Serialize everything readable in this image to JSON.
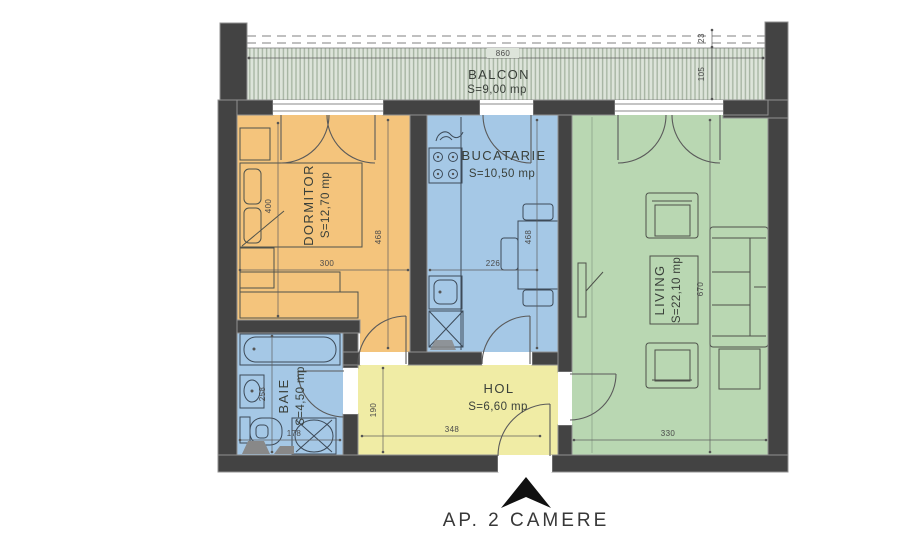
{
  "title": "AP. 2 CAMERE",
  "balcony": {
    "name": "BALCON",
    "area": "S=9,00 mp"
  },
  "rooms": {
    "dormitor": {
      "name": "DORMITOR",
      "area": "S=12,70 mp"
    },
    "bucatarie": {
      "name": "BUCATARIE",
      "area": "S=10,50 mp"
    },
    "living": {
      "name": "LIVING",
      "area": "S=22,10 mp"
    },
    "baie": {
      "name": "BAIE",
      "area": "S=4,50 mp"
    },
    "hol": {
      "name": "HOL",
      "area": "S=6,60 mp"
    }
  },
  "dimensions": {
    "balcony_width": "860",
    "balcony_overhang": "23",
    "balcony_depth": "105",
    "dormitor_bed": "400",
    "dormitor_depth": "468",
    "dormitor_width": "300",
    "bucatarie_width": "226",
    "bucatarie_depth": "468",
    "living_depth": "670",
    "living_width": "330",
    "baie_depth": "258",
    "baie_width": "178",
    "hol_depth": "190",
    "hol_width": "348"
  },
  "colors": {
    "wall": "#434343",
    "dormitor": "#f4c47c",
    "bucatarie": "#a5c8e6",
    "living": "#b9d7b2",
    "baie": "#a5c8e6",
    "hol": "#f0eca5",
    "balcony_bg": "#dde4da",
    "balcony_stripe": "#a8b6a4"
  }
}
